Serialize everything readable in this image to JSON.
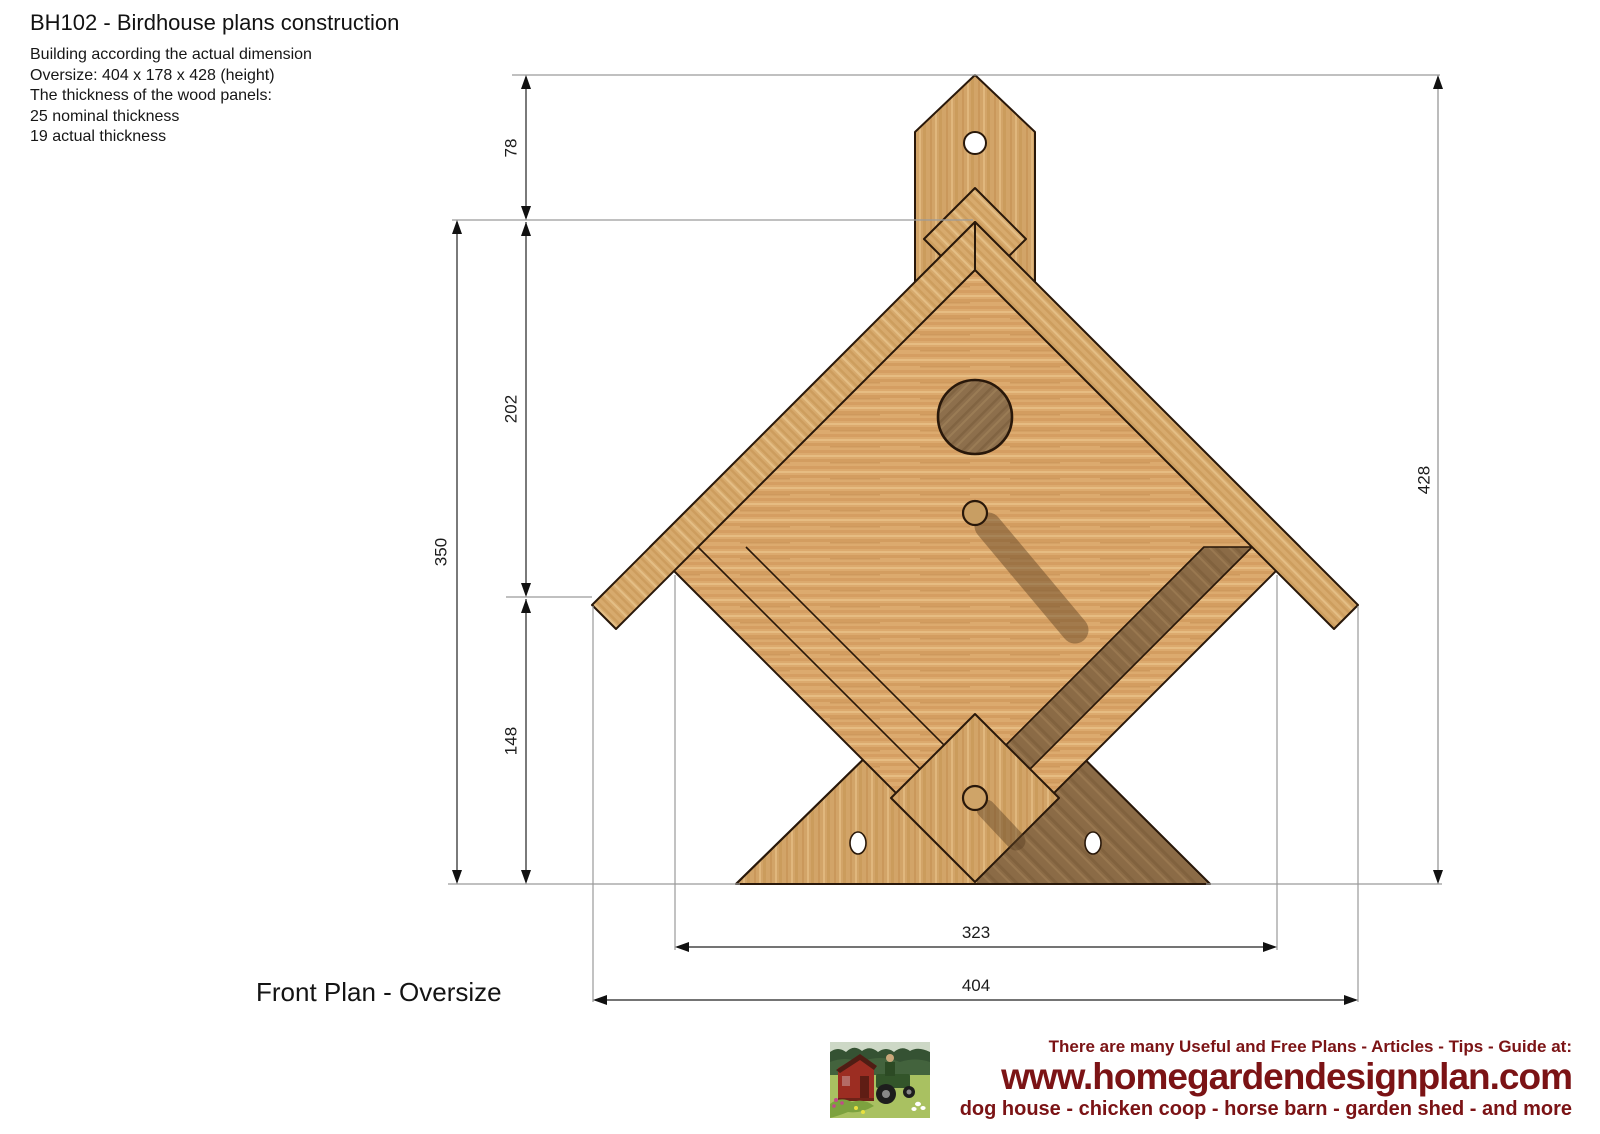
{
  "header": {
    "title": "BH102 - Birdhouse plans construction",
    "notes": [
      "Building according the actual dimension",
      "Oversize: 404 x 178 x 428 (height)",
      "The thickness of the wood panels:",
      "25 nominal thickness",
      "19 actual thickness"
    ]
  },
  "drawing": {
    "caption": "Front Plan - Oversize",
    "dimensions": {
      "peak_to_body": "78",
      "body_upper": "202",
      "body_total": "350",
      "lower": "148",
      "total_height": "428",
      "inner_width": "323",
      "total_width": "404"
    }
  },
  "footer": {
    "tagline": "There are many Useful and Free Plans - Articles - Tips - Guide at:",
    "url": "www.homegardendesignplan.com",
    "subline": "dog house - chicken coop - horse barn - garden shed - and more",
    "accent_color": "#7b1315"
  },
  "palette": {
    "wood_light": "#dcaa6e",
    "wood_mid": "#d0a267",
    "wood_dark": "#8b6b46",
    "outline": "#29180a",
    "extension_line": "#9a9a9a",
    "dimension_line": "#222222"
  }
}
